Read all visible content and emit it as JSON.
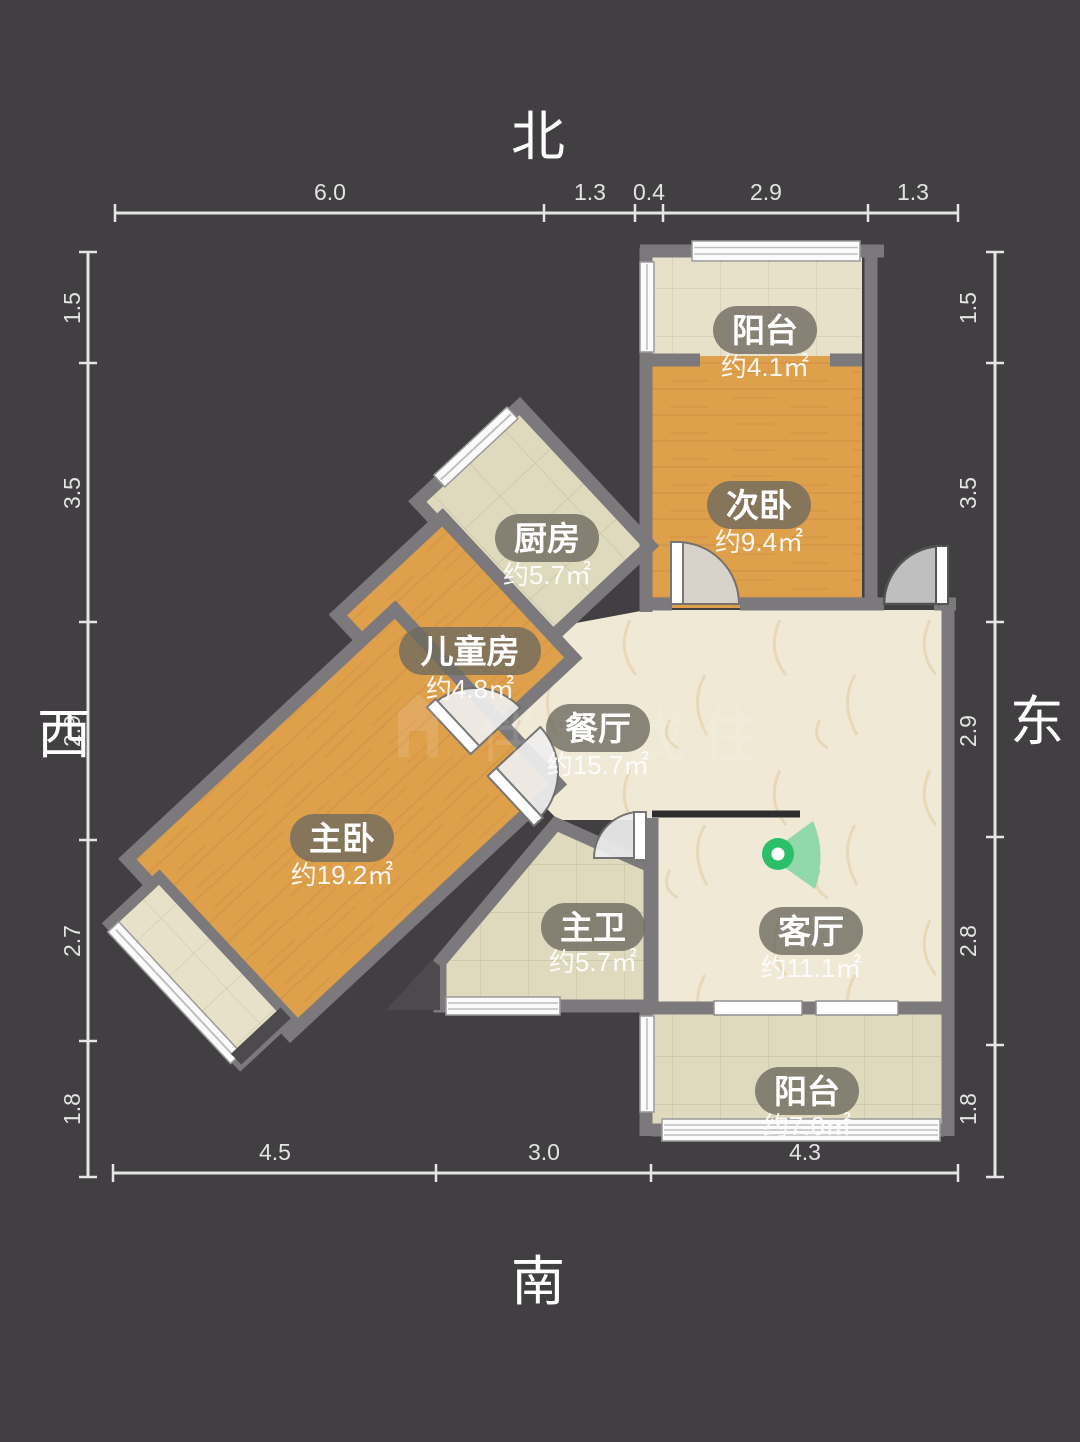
{
  "compass": {
    "north": "北",
    "south": "南",
    "west": "西",
    "east": "东"
  },
  "rulers": {
    "top": {
      "labels": [
        "6.0",
        "1.3",
        "0.4",
        "2.9",
        "1.3"
      ]
    },
    "bottom": {
      "labels": [
        "4.5",
        "3.0",
        "4.3"
      ]
    },
    "left": {
      "labels": [
        "1.5",
        "3.5",
        "2.9",
        "2.7",
        "1.8"
      ]
    },
    "right": {
      "labels": [
        "1.5",
        "3.5",
        "2.9",
        "2.8",
        "1.8"
      ]
    }
  },
  "rooms": [
    {
      "id": "balcony-north",
      "name": "阳台",
      "area": "约4.1㎡"
    },
    {
      "id": "secondary-bedroom",
      "name": "次卧",
      "area": "约9.4㎡"
    },
    {
      "id": "kitchen",
      "name": "厨房",
      "area": "约5.7㎡"
    },
    {
      "id": "kids-room",
      "name": "儿童房",
      "area": "约4.8㎡"
    },
    {
      "id": "dining-room",
      "name": "餐厅",
      "area": "约15.7㎡"
    },
    {
      "id": "master-bedroom",
      "name": "主卧",
      "area": "约19.2㎡"
    },
    {
      "id": "master-bath",
      "name": "主卫",
      "area": "约5.7㎡"
    },
    {
      "id": "living-room",
      "name": "客厅",
      "area": "约11.1㎡"
    },
    {
      "id": "balcony-south",
      "name": "阳台",
      "area": "约7.0㎡"
    }
  ],
  "watermark": {
    "text": "伴里找住"
  },
  "icons": {
    "camera": "camera-viewpoint-icon"
  },
  "colors": {
    "background": "#413f41",
    "wall": "#7b797c",
    "wood_floor": "#dfa04c",
    "wood_streak": "#c8873b",
    "tile_beige": "#e8e1ca",
    "tile_green": "#dfdabd",
    "tile_line": "#c9c2a6",
    "marble": "#f0e9d6",
    "marble_vein": "#dfc9a0",
    "label_bubble": "#6e6a5f",
    "camera_green": "#2abf68",
    "camera_cone": "#86d6a6",
    "door_fill": "#d8d8d8",
    "window_white": "#fbfbfb"
  }
}
